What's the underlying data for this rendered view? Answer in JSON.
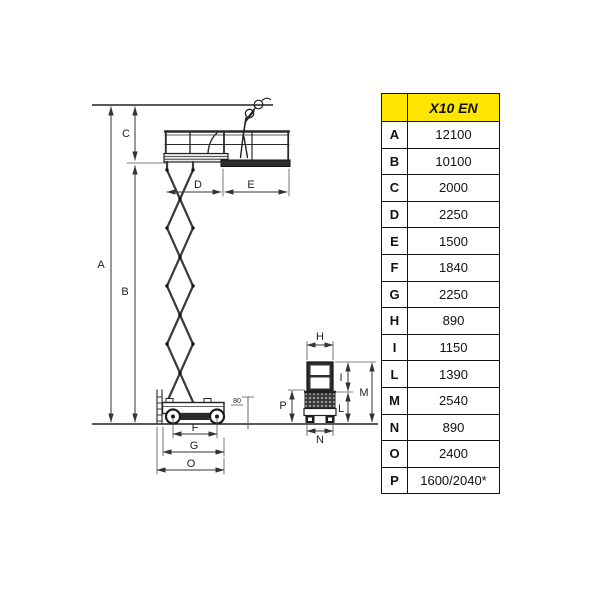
{
  "table": {
    "header_label": "X10 EN",
    "yellow": "#ffe600",
    "rows": [
      {
        "key": "A",
        "value": "12100"
      },
      {
        "key": "B",
        "value": "10100"
      },
      {
        "key": "C",
        "value": "2000"
      },
      {
        "key": "D",
        "value": "2250"
      },
      {
        "key": "E",
        "value": "1500"
      },
      {
        "key": "F",
        "value": "1840"
      },
      {
        "key": "G",
        "value": "2250"
      },
      {
        "key": "H",
        "value": "890"
      },
      {
        "key": "I",
        "value": "1150"
      },
      {
        "key": "L",
        "value": "1390"
      },
      {
        "key": "M",
        "value": "2540"
      },
      {
        "key": "N",
        "value": "890"
      },
      {
        "key": "O",
        "value": "2400"
      },
      {
        "key": "P",
        "value": "1600/2040*"
      }
    ]
  },
  "diagram": {
    "elevation_labels": {
      "A": "A",
      "B": "B",
      "C": "C",
      "D": "D",
      "E": "E",
      "F": "F",
      "G": "G",
      "O": "O",
      "clearance": "80"
    },
    "stowed_labels": {
      "H": "H",
      "I": "I",
      "L": "L",
      "M": "M",
      "N": "N",
      "P": "P"
    }
  }
}
